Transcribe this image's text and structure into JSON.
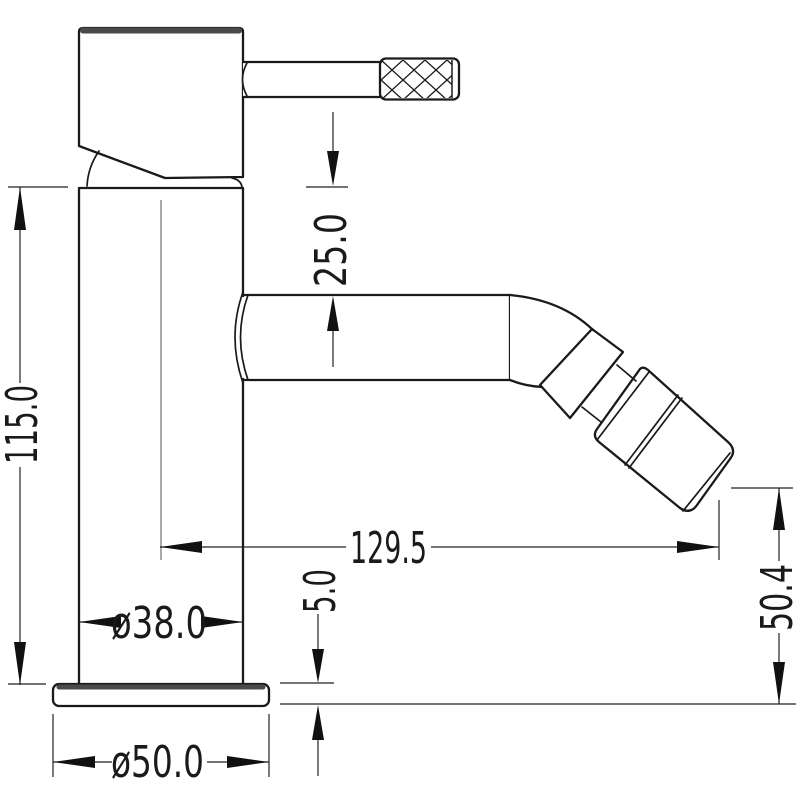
{
  "drawing": {
    "kind": "technical-dimension-drawing",
    "subject": "single-lever mixer tap side elevation",
    "units": "mm",
    "dimensions": {
      "total_height": "115.0",
      "head_to_spout_top": "25.0",
      "spout_reach": "129.5",
      "outlet_height": "50.4",
      "base_plate_thickness": "5.0",
      "body_diameter": "ø38.0",
      "base_diameter": "ø50.0"
    },
    "colors": {
      "line": "#1a1a1a",
      "edge_highlight": "#4a4a4a",
      "background": "#ffffff"
    }
  }
}
